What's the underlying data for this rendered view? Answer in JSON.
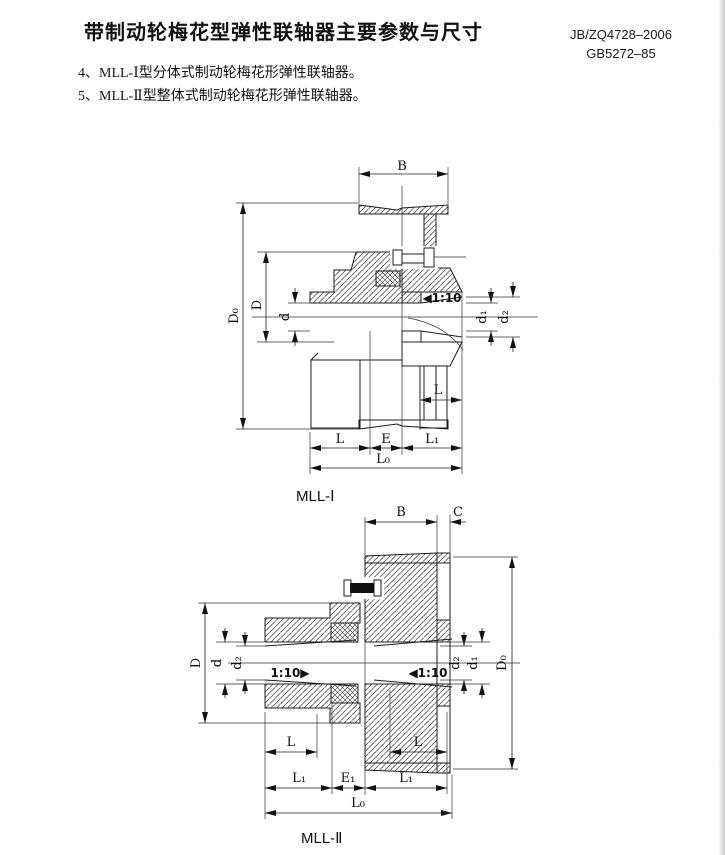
{
  "colors": {
    "ink": "#1c1c1c",
    "paper": "#ffffff"
  },
  "header": {
    "title": "带制动轮梅花型弹性联轴器主要参数与尺寸",
    "standard_1": "JB/ZQ4728–2006",
    "standard_2": "GB5272–85"
  },
  "notes": {
    "item_4": "4、MLL-Ⅰ型分体式制动轮梅花形弹性联轴器。",
    "item_5": "5、MLL-Ⅱ型整体式制动轮梅花形弹性联轴器。"
  },
  "mll1": {
    "caption": "MLL-Ⅰ",
    "dims": {
      "B": "B",
      "D0": "D₀",
      "D": "D",
      "d": "d",
      "taper_right": "◀1:10",
      "d1": "d₁",
      "d2": "d₂",
      "L_hub_right": "L",
      "L": "L",
      "E": "E",
      "L1": "L₁",
      "L0": "L₀"
    }
  },
  "mll2": {
    "caption": "MLL-Ⅱ",
    "dims": {
      "B": "B",
      "C": "C",
      "D": "D",
      "d": "d",
      "d2_left": "d₂",
      "taper_left": "1:10▶",
      "taper_right": "◀1:10",
      "d2_right": "d₂",
      "d1": "d₁",
      "D0": "D₀",
      "L_left": "L",
      "L_right": "L",
      "L1_left": "L₁",
      "E1": "E₁",
      "L1_right": "L₁",
      "L0": "L₀"
    }
  }
}
